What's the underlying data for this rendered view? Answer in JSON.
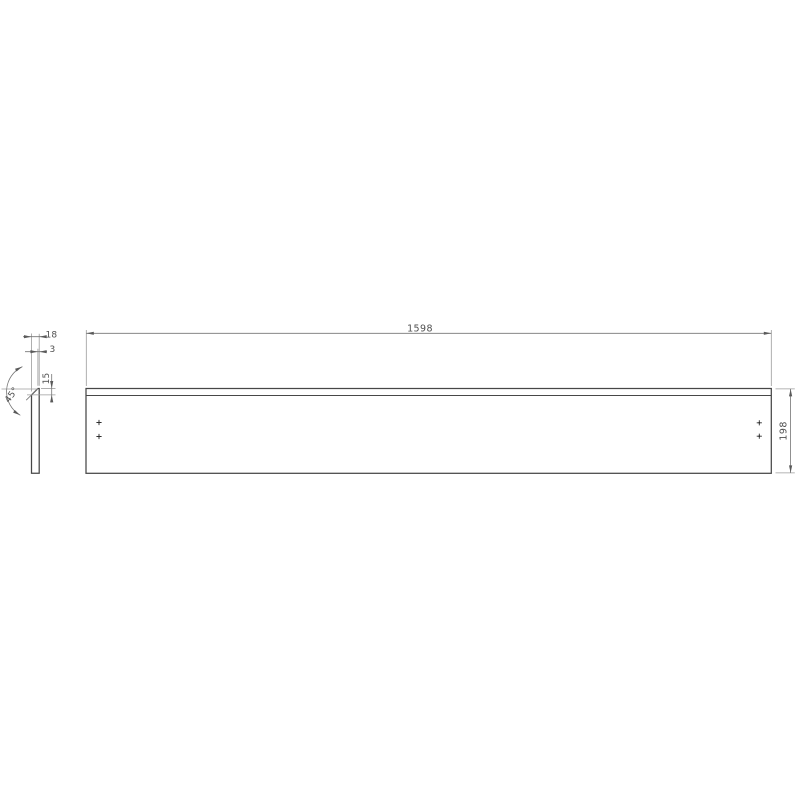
{
  "drawing": {
    "type": "technical-drawing",
    "subject": "long rectangular panel with beveled top edge",
    "background_color": "#ffffff",
    "views": {
      "front": {
        "length_mm": 1598,
        "height_mm": 198,
        "hole_marker_count": 4
      },
      "side": {
        "thickness_mm": 18,
        "top_flat_mm": 3,
        "bevel_height_mm": 15,
        "bevel_angle_deg": 45
      }
    },
    "dimensions": {
      "length": "1598",
      "height": "198",
      "thickness": "18",
      "top_flat": "3",
      "bevel_height": "15",
      "bevel_angle": "45°"
    },
    "colors": {
      "outline": "#474747",
      "dimension_line": "#757575",
      "extension_line": "#9b9b9b",
      "text": "#4f4f4f",
      "background": "#ffffff"
    }
  }
}
